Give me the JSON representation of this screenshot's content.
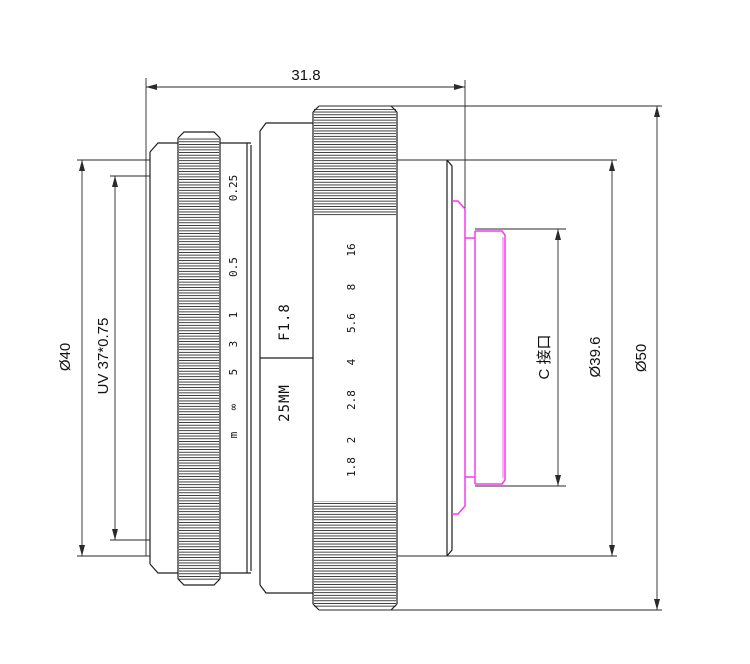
{
  "drawing": {
    "type": "lens-technical-drawing",
    "dimensions": {
      "length": "31.8",
      "front_diameter": "Ø40",
      "filter_thread": "UV 37*0.75",
      "mount_label": "C 接口",
      "rear_diameter": "Ø39.6",
      "outer_diameter": "Ø50"
    },
    "lens": {
      "aperture_label": "F1.8",
      "focal_label": "25MM"
    },
    "focus_scale": [
      "0.25",
      "0.5",
      "1",
      "3",
      "5",
      "∞",
      "m"
    ],
    "aperture_scale": [
      "16",
      "8",
      "5.6",
      "4",
      "2.8",
      "2",
      "1.8"
    ],
    "colors": {
      "line": "#1e1e1e",
      "mount_highlight": "#f53af0",
      "background": "#ffffff"
    }
  }
}
